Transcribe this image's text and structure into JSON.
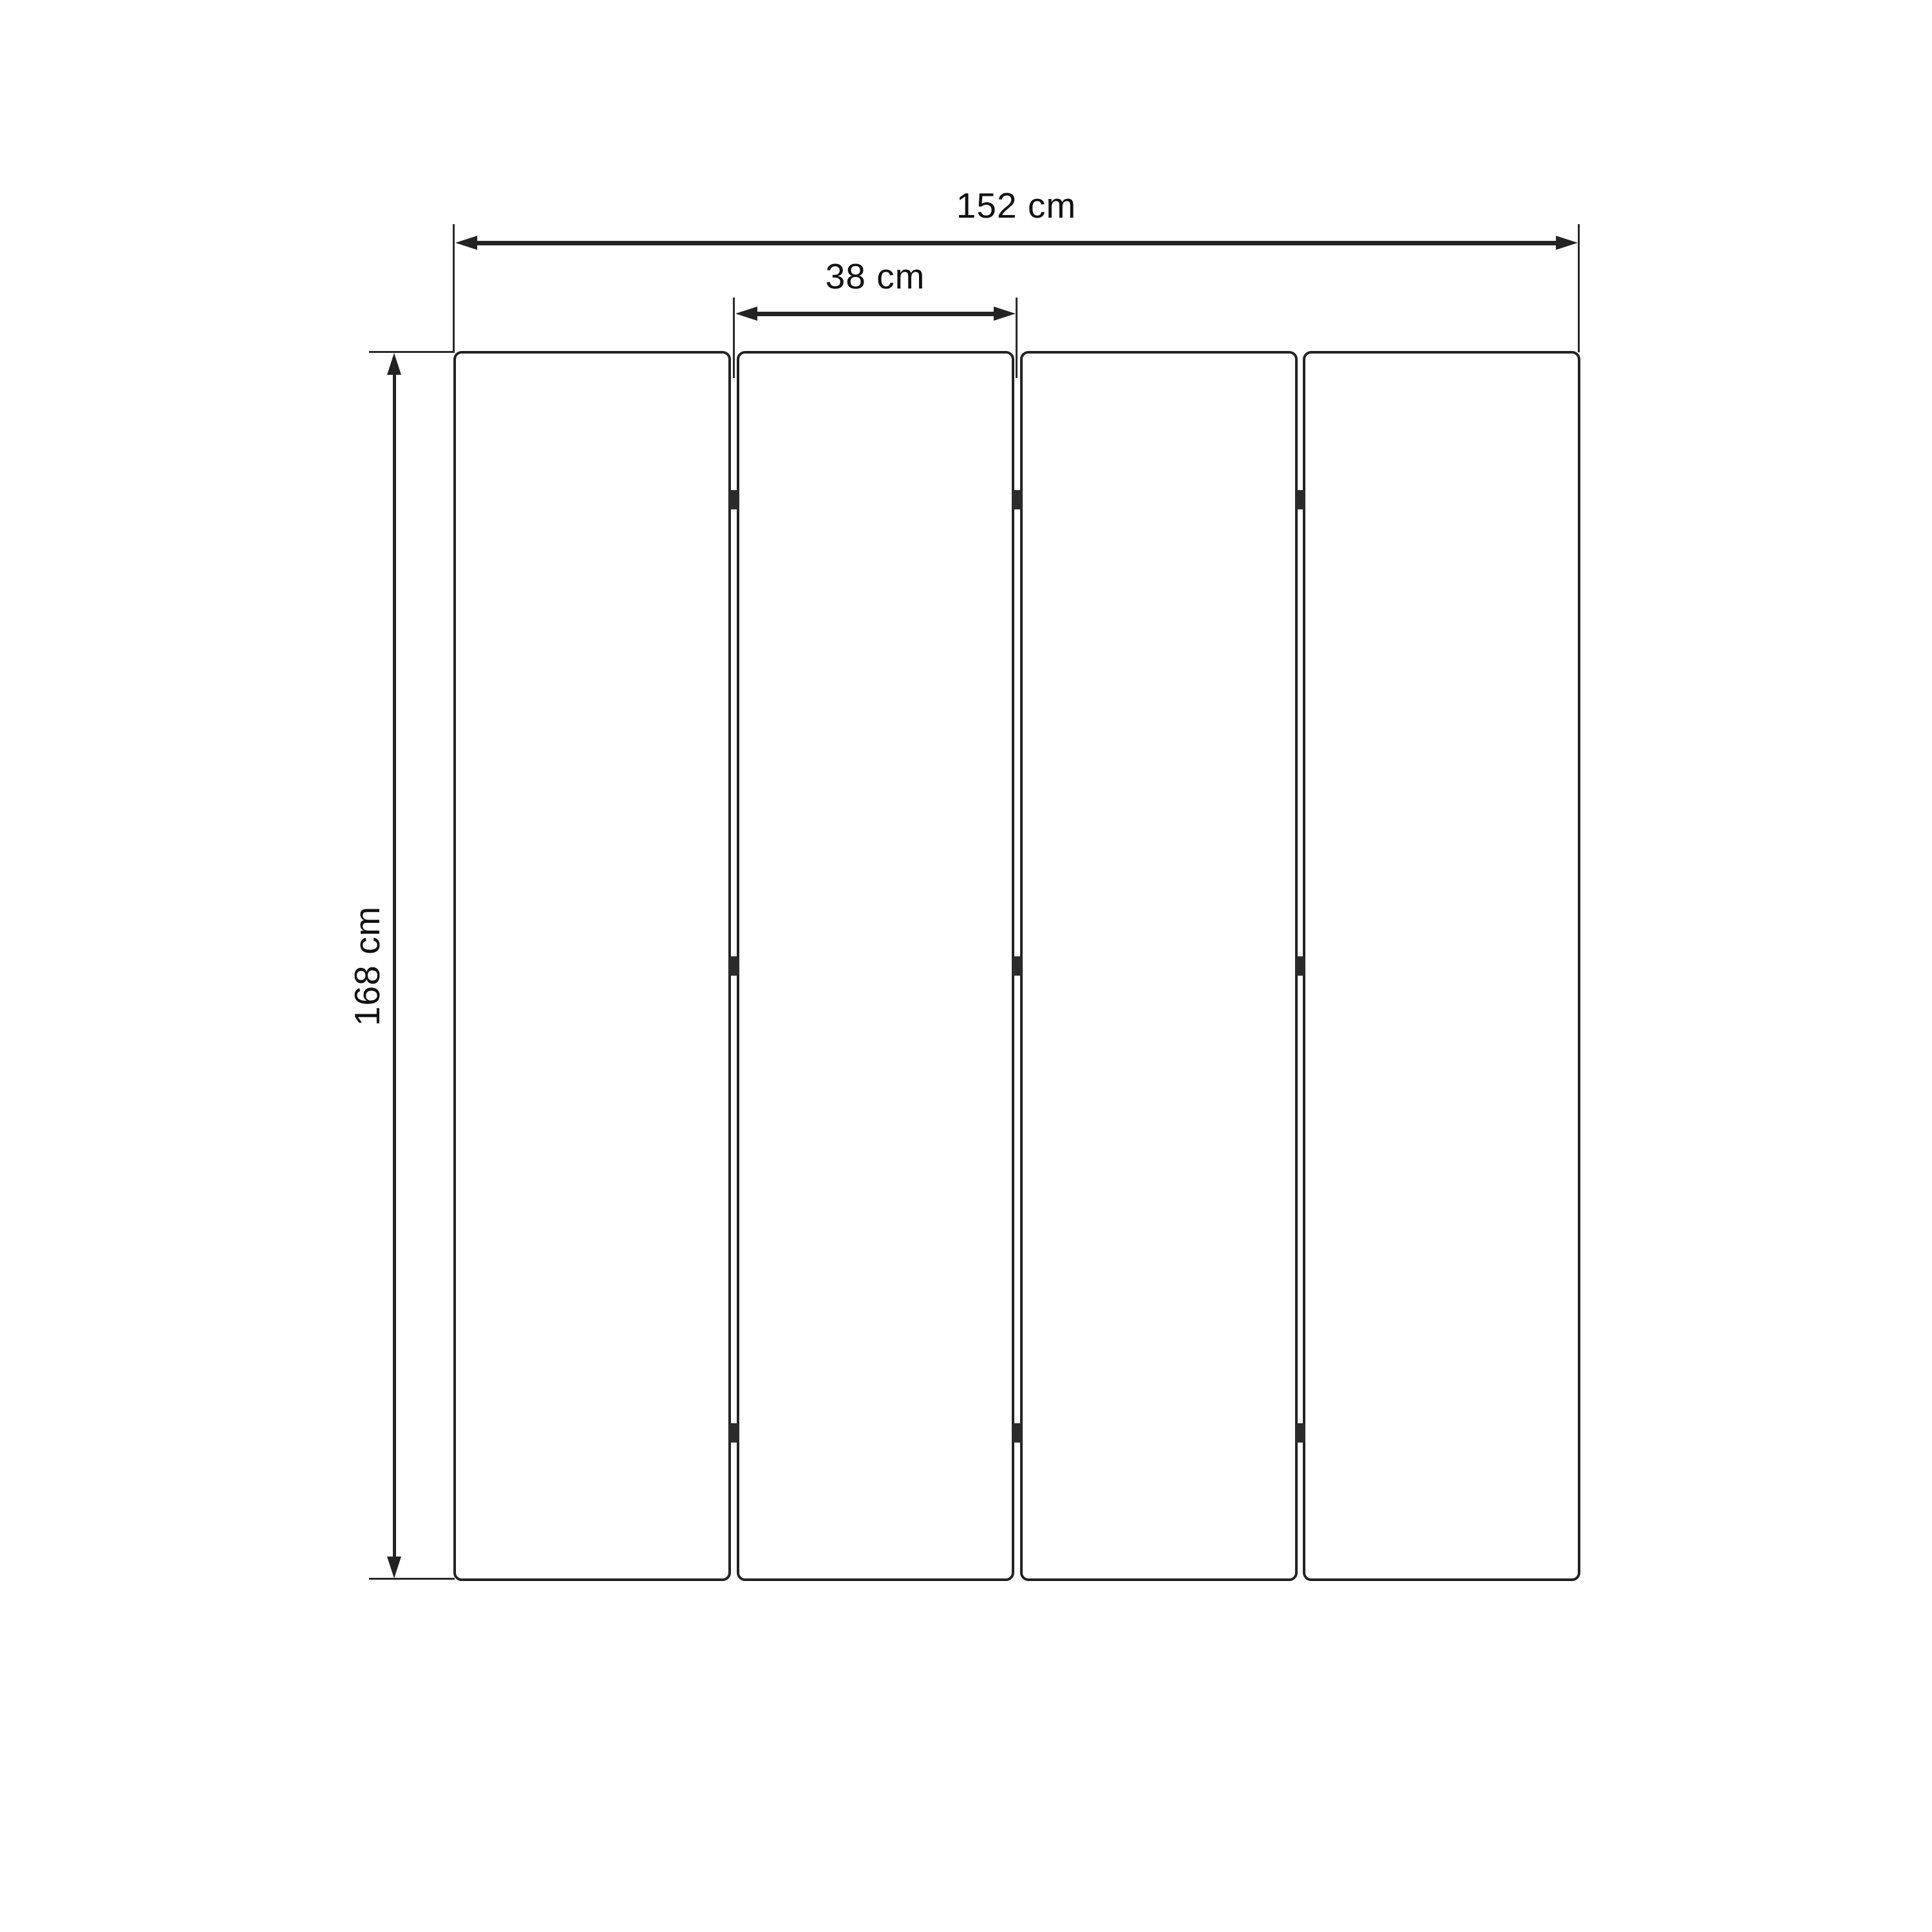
{
  "diagram": {
    "subject": "four-panel folding room divider, front elevation dimension drawing",
    "background_color": "#ffffff",
    "line_color": "#232323",
    "hinge_color": "#2b2b2b",
    "text_color": "#111111",
    "labels": {
      "total_width": "152 cm",
      "panel_width": "38 cm",
      "height": "168 cm"
    },
    "panels": {
      "count": 4,
      "gaps": 3,
      "hinges_per_gap": 3
    }
  }
}
